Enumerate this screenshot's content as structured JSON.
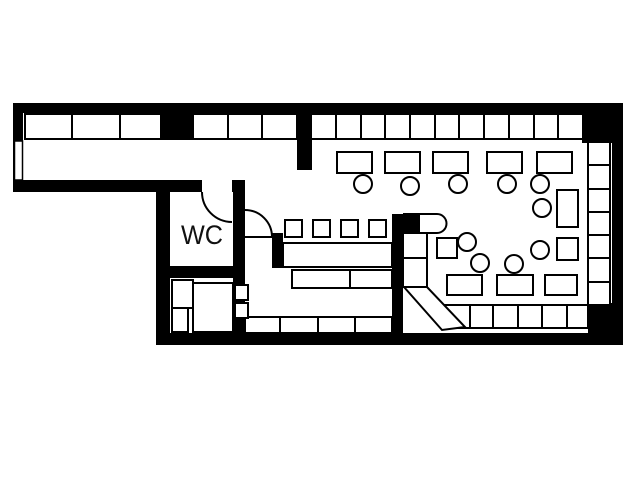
{
  "floorplan": {
    "wc_label": "WC",
    "colors": {
      "wall": "#000000",
      "floor": "#ffffff",
      "line": "#000000"
    },
    "layers": [
      {
        "kind": "polygon",
        "item_name": "floor-area",
        "fill": "#ffffff",
        "stroke": "none",
        "sw": 0,
        "items": [
          "23,113 612,113 612,333 170,333 170,192 23,192"
        ]
      },
      {
        "kind": "rect",
        "item_name": "wall",
        "fill": "#000000",
        "stroke": "none",
        "sw": 0,
        "items": [
          [
            13,
            103,
            610,
            10
          ],
          [
            13,
            103,
            10,
            89
          ],
          [
            13,
            180,
            189,
            12
          ],
          [
            232,
            180,
            13,
            12
          ],
          [
            612,
            103,
            11,
            242
          ],
          [
            582,
            103,
            41,
            40
          ],
          [
            156,
            333,
            467,
            12
          ],
          [
            588,
            303,
            35,
            42
          ],
          [
            156,
            192,
            14,
            153
          ],
          [
            233,
            192,
            12,
            141
          ],
          [
            156,
            266,
            89,
            12
          ],
          [
            161,
            113,
            32,
            27
          ],
          [
            297,
            103,
            15,
            67
          ],
          [
            272,
            233,
            11,
            35
          ],
          [
            392,
            214,
            11,
            131
          ]
        ]
      },
      {
        "kind": "rect",
        "item_name": "window",
        "fill": "#ffffff",
        "stroke": "#000000",
        "sw": 1.5,
        "items": [
          [
            14.5,
            141,
            8,
            39
          ]
        ]
      },
      {
        "kind": "rect",
        "item_name": "wc-door-opening",
        "fill": "#ffffff",
        "stroke": "none",
        "sw": 0,
        "items": [
          [
            202,
            181,
            30,
            11
          ]
        ]
      },
      {
        "kind": "rect",
        "item_name": "bench-seat",
        "fill": "#ffffff",
        "stroke": "#000000",
        "sw": 2,
        "items": [
          [
            25,
            114,
            47,
            25
          ],
          [
            72,
            114,
            48,
            25
          ],
          [
            120,
            114,
            41,
            25
          ],
          [
            193,
            114,
            35,
            25
          ],
          [
            228,
            114,
            34,
            25
          ],
          [
            262,
            114,
            35,
            25
          ],
          [
            311,
            114,
            25,
            25
          ],
          [
            336,
            114,
            25,
            25
          ],
          [
            361,
            114,
            24,
            25
          ],
          [
            385,
            114,
            25,
            25
          ],
          [
            410,
            114,
            25,
            25
          ],
          [
            435,
            114,
            24,
            25
          ],
          [
            459,
            114,
            25,
            25
          ],
          [
            484,
            114,
            25,
            25
          ],
          [
            509,
            114,
            25,
            25
          ],
          [
            534,
            114,
            24,
            25
          ],
          [
            558,
            114,
            25,
            25
          ],
          [
            588,
            142,
            22,
            23
          ],
          [
            588,
            165,
            22,
            24
          ],
          [
            588,
            189,
            22,
            23
          ],
          [
            588,
            212,
            22,
            23
          ],
          [
            588,
            235,
            22,
            23
          ],
          [
            588,
            258,
            22,
            24
          ],
          [
            588,
            282,
            22,
            23
          ],
          [
            245,
            317,
            35,
            16
          ],
          [
            280,
            317,
            38,
            16
          ],
          [
            318,
            317,
            37,
            16
          ],
          [
            355,
            317,
            37,
            16
          ],
          [
            445,
            305,
            25,
            23
          ],
          [
            470,
            305,
            23,
            23
          ],
          [
            493,
            305,
            25,
            23
          ],
          [
            518,
            305,
            24,
            23
          ],
          [
            542,
            305,
            25,
            23
          ],
          [
            567,
            305,
            21,
            23
          ],
          [
            403,
            233,
            24,
            25
          ],
          [
            403,
            258,
            24,
            29
          ]
        ]
      },
      {
        "kind": "polygon",
        "item_name": "bench-diagonal",
        "fill": "#ffffff",
        "stroke": "#000000",
        "sw": 2,
        "items": [
          "404,287 427,287 465,327 442,330"
        ]
      },
      {
        "kind": "rect",
        "item_name": "bar-counter",
        "fill": "#ffffff",
        "stroke": "#000000",
        "sw": 2,
        "items": [
          [
            283,
            243,
            109,
            24
          ]
        ]
      },
      {
        "kind": "rect",
        "item_name": "back-counter",
        "fill": "#ffffff",
        "stroke": "#000000",
        "sw": 2,
        "items": [
          [
            292,
            270,
            58,
            18
          ],
          [
            350,
            270,
            42,
            18
          ]
        ]
      },
      {
        "kind": "path",
        "item_name": "bar-counter-end",
        "fill": "#ffffff",
        "stroke": "#000000",
        "sw": 2,
        "items": [
          "M404,214 L437,214 A9.5,9.5 0 0 1 437,233 L404,233 Z"
        ]
      },
      {
        "kind": "rect",
        "item_name": "wall-stub",
        "fill": "#000000",
        "stroke": "none",
        "sw": 0,
        "items": [
          [
            392,
            214,
            28,
            19
          ]
        ]
      },
      {
        "kind": "rect",
        "item_name": "table",
        "fill": "#ffffff",
        "stroke": "#000000",
        "sw": 2,
        "items": [
          [
            337,
            152,
            35,
            21
          ],
          [
            385,
            152,
            35,
            21
          ],
          [
            433,
            152,
            35,
            21
          ],
          [
            487,
            152,
            35,
            21
          ],
          [
            537,
            152,
            35,
            21
          ],
          [
            557,
            190,
            21,
            37
          ],
          [
            557,
            238,
            21,
            22
          ],
          [
            447,
            275,
            35,
            20
          ],
          [
            497,
            275,
            36,
            20
          ],
          [
            545,
            275,
            32,
            20
          ]
        ]
      },
      {
        "kind": "rect",
        "item_name": "stool",
        "fill": "#ffffff",
        "stroke": "#000000",
        "sw": 2,
        "items": [
          [
            285,
            220,
            17,
            17
          ],
          [
            313,
            220,
            17,
            17
          ],
          [
            341,
            220,
            17,
            17
          ],
          [
            369,
            220,
            17,
            17
          ],
          [
            437,
            238,
            20,
            20
          ]
        ]
      },
      {
        "kind": "circle",
        "item_name": "chair",
        "fill": "#ffffff",
        "stroke": "#000000",
        "sw": 2,
        "items": [
          [
            363,
            184,
            9
          ],
          [
            410,
            186,
            9
          ],
          [
            458,
            184,
            9
          ],
          [
            507,
            184,
            9
          ],
          [
            540,
            184,
            9
          ],
          [
            542,
            208,
            9
          ],
          [
            540,
            250,
            9
          ],
          [
            467,
            242,
            9
          ],
          [
            480,
            263,
            9
          ],
          [
            514,
            264,
            9
          ]
        ]
      },
      {
        "kind": "rect",
        "item_name": "fixture",
        "fill": "#ffffff",
        "stroke": "#000000",
        "sw": 2,
        "items": [
          [
            172,
            280,
            21,
            28
          ],
          [
            172,
            308,
            16,
            24
          ],
          [
            193,
            283,
            40,
            49
          ],
          [
            235,
            285,
            13,
            15
          ],
          [
            235,
            303,
            13,
            15
          ]
        ]
      },
      {
        "kind": "path",
        "item_name": "door-arc",
        "fill": "none",
        "stroke": "#000000",
        "sw": 2,
        "items": [
          "M202,192 A30,30 0 0 0 232,222",
          "M245,210 A27,27 0 0 1 272,237",
          "M245,237 L272,237"
        ]
      }
    ]
  }
}
